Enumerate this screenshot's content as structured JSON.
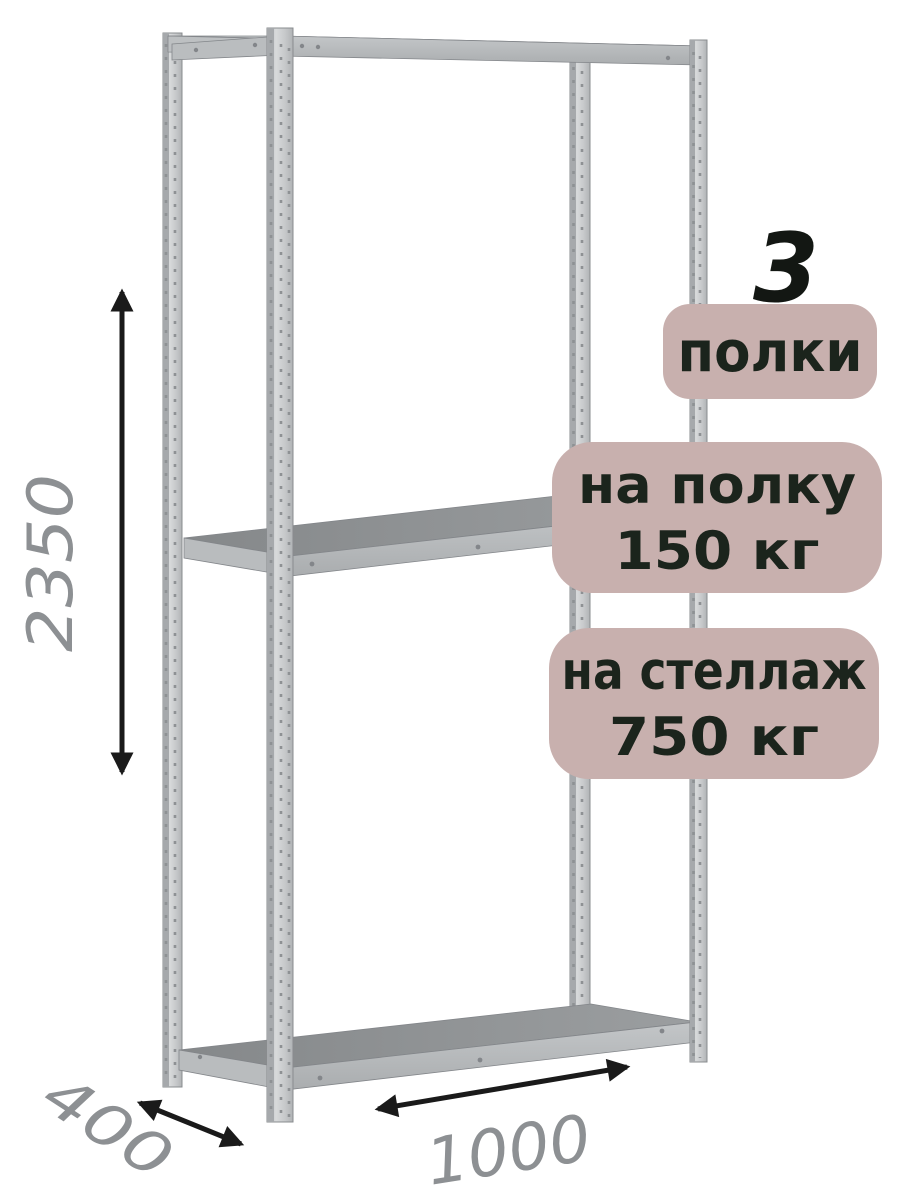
{
  "product": {
    "shelf_count": "3",
    "shelf_count_badge": "полки",
    "shelf_load_badge": {
      "line1": "на полку",
      "line2": "150 кг"
    },
    "rack_load_badge": {
      "line1": "на стеллаж",
      "line2": "750 кг"
    }
  },
  "dimensions": {
    "height_mm": "2350",
    "depth_mm": "400",
    "width_mm": "1000"
  },
  "colors": {
    "badge_bg": "#c8b0ae",
    "badge_text": "#1b241c",
    "count_text": "#131713",
    "dim_text": "#8d9093",
    "arrow": "#1a1a1a",
    "metal_light": "#d5d7d8",
    "metal_mid": "#b4b7b9",
    "metal_dark": "#8b8e90"
  }
}
